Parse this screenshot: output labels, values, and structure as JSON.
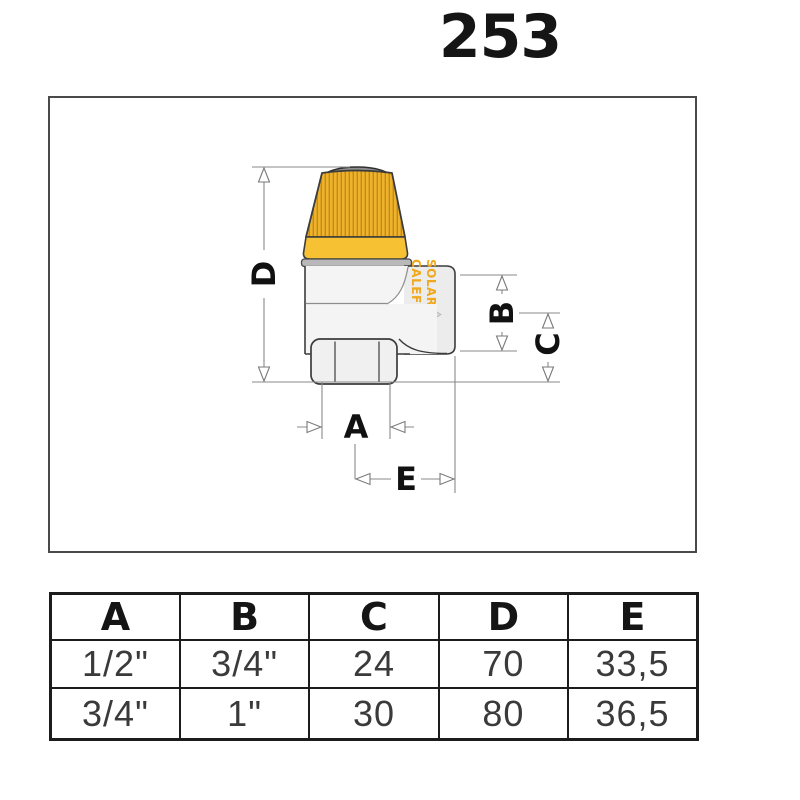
{
  "title": "253",
  "drawing": {
    "dim_labels": {
      "a": "A",
      "b": "B",
      "c": "C",
      "d": "D",
      "e": "E"
    },
    "brand_text": {
      "line1": "CALEFFI",
      "line2": "SOLAR"
    }
  },
  "table": {
    "headers": [
      "A",
      "B",
      "C",
      "D",
      "E"
    ],
    "rows": [
      [
        "1/2\"",
        "3/4\"",
        "24",
        "70",
        "33,5"
      ],
      [
        "3/4\"",
        "1\"",
        "30",
        "80",
        "36,5"
      ]
    ]
  },
  "colors": {
    "cap_yellow": "#efb32b",
    "cap_band": "#f6c233",
    "cap_rib": "#c08a1e",
    "metal_light": "#f4f4f4",
    "metal_mid": "#ececec",
    "flange_gray": "#b9b9b9",
    "outline": "#3c3c3c",
    "dim_line": "#8a8a8a",
    "label_black": "#111111",
    "brand_orange": "#f0a81c",
    "arrow_gray": "#d6d6d6",
    "table_border": "#1c1c1c",
    "table_text": "#3a3a3a"
  }
}
